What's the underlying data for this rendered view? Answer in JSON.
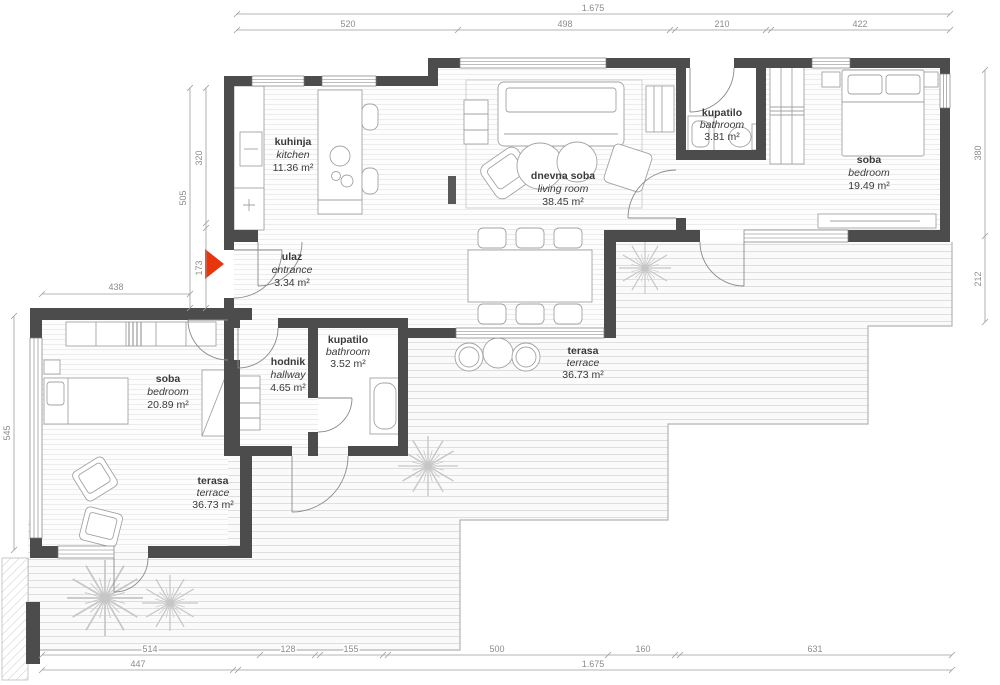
{
  "plan": {
    "title": "apartment-floor-plan",
    "rooms": [
      {
        "name": "kuhinja",
        "name_en": "kitchen",
        "area": "11.36 m²"
      },
      {
        "name": "dnevna soba",
        "name_en": "living room",
        "area": "38.45 m²"
      },
      {
        "name": "kupatilo",
        "name_en": "bathroom",
        "area": "3.81 m²"
      },
      {
        "name": "soba",
        "name_en": "bedroom",
        "area": "19.49 m²"
      },
      {
        "name": "ulaz",
        "name_en": "entrance",
        "area": "3.34 m²"
      },
      {
        "name": "hodnik",
        "name_en": "hallway",
        "area": "4.65 m²"
      },
      {
        "name": "kupatilo",
        "name_en": "bathroom",
        "area": "3.52 m²"
      },
      {
        "name": "soba",
        "name_en": "bedroom",
        "area": "20.89 m²"
      },
      {
        "name": "terasa",
        "name_en": "terrace",
        "area": "36.73 m²"
      },
      {
        "name": "terasa",
        "name_en": "terrace",
        "area": "36.73 m²"
      }
    ],
    "dimensions": {
      "top_total": "1.675",
      "top": [
        "520",
        "498",
        "210",
        "422"
      ],
      "left_total": "505",
      "left": [
        "320",
        "173"
      ],
      "left_h": "438",
      "left_lower": "545",
      "right": [
        "380",
        "212"
      ],
      "bottom": [
        "514",
        "128",
        "155",
        "500",
        "160",
        "631"
      ],
      "bottom_total": [
        "447",
        "1.675"
      ]
    },
    "colors": {
      "wall": "#4c4c4c",
      "entrance_arrow": "#e8350e"
    }
  }
}
